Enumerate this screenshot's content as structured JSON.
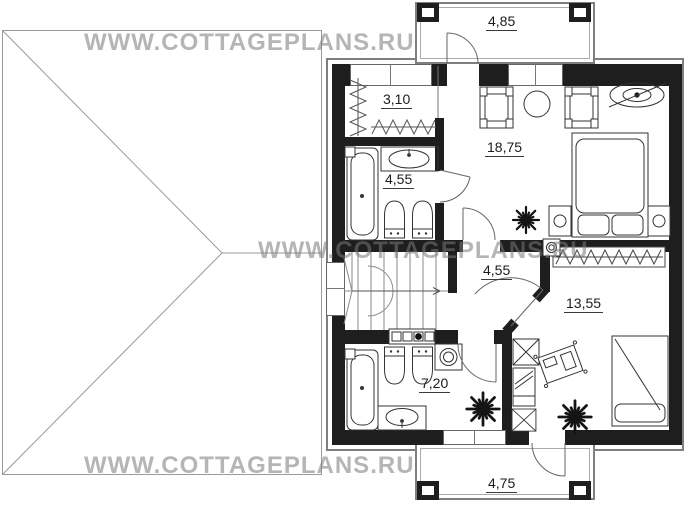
{
  "watermark": {
    "text": "WWW.COTTAGEPLANS.RU"
  },
  "floor_plan": {
    "rooms": [
      {
        "id": "balcony-top",
        "area": "4,85"
      },
      {
        "id": "closet",
        "area": "3,10"
      },
      {
        "id": "bathroom-top",
        "area": "4,55"
      },
      {
        "id": "bedroom-main",
        "area": "18,75"
      },
      {
        "id": "hall",
        "area": "4,55"
      },
      {
        "id": "bedroom-second",
        "area": "13,55"
      },
      {
        "id": "bathroom-bottom",
        "area": "7,20"
      },
      {
        "id": "balcony-bottom",
        "area": "4,75"
      }
    ]
  },
  "colors": {
    "wall": "#1e1e1e",
    "outer_outline": "#7f7f7f",
    "furniture_line": "#333333",
    "watermark": "#787878",
    "label": "#1c1c1c"
  }
}
